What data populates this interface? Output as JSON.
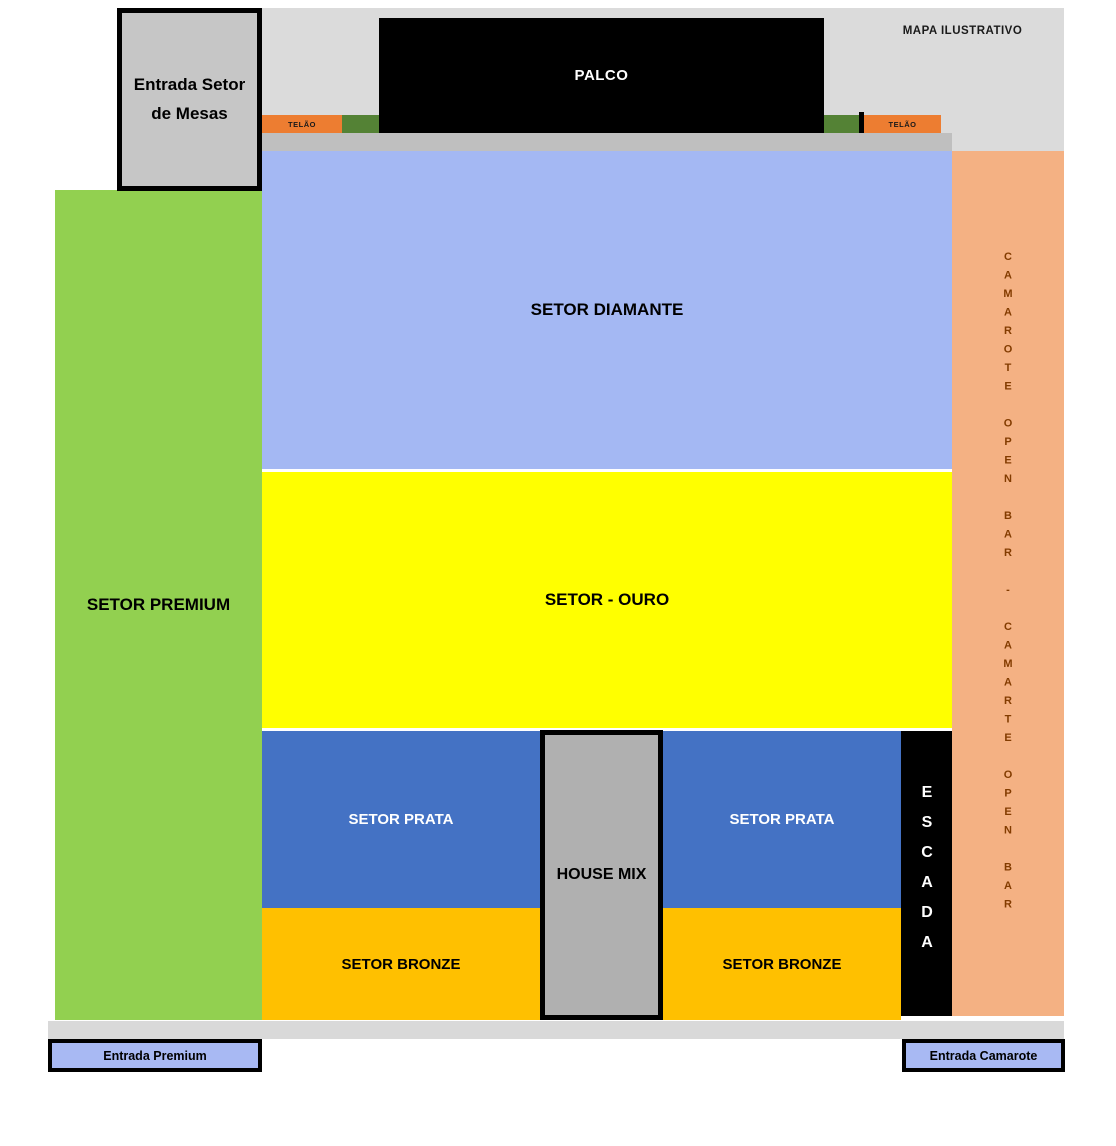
{
  "meta": {
    "map_label": "MAPA ILUSTRATIVO"
  },
  "stage": {
    "label": "PALCO"
  },
  "screens": {
    "left_label": "TELÃO",
    "right_label": "TELÃO"
  },
  "sectors": {
    "premium": "SETOR PREMIUM",
    "diamante": "SETOR DIAMANTE",
    "ouro": "SETOR - OURO",
    "prata_left": "SETOR PRATA",
    "prata_right": "SETOR PRATA",
    "bronze_left": "SETOR BRONZE",
    "bronze_right": "SETOR BRONZE",
    "house_mix": "HOUSE MIX",
    "escada_vertical": "ESCADA",
    "camarote_vertical": "CAMAROTE OPEN BAR - CAMARTE OPEN BAR"
  },
  "entrances": {
    "mesas": "Entrada Setor de Mesas",
    "premium": "Entrada Premium",
    "camarote": "Entrada Camarote"
  },
  "colors": {
    "top_bg": "#DBDBDB",
    "dark_strip": "#BFBFBF",
    "stage": "#000000",
    "telao": "#ED7D31",
    "greenbox": "#548235",
    "mesas_gray": "#C6C6C6",
    "premium": "#92D050",
    "diamante": "#A4B8F3",
    "ouro": "#FFFF00",
    "prata": "#4472C4",
    "bronze": "#FFC000",
    "house_mix": "#B0B0B0",
    "camarote": "#F4B183",
    "camarote_text": "#833C00",
    "bottom_strip": "#D9D9D9",
    "entrada_blue": "#A8B9F3"
  }
}
